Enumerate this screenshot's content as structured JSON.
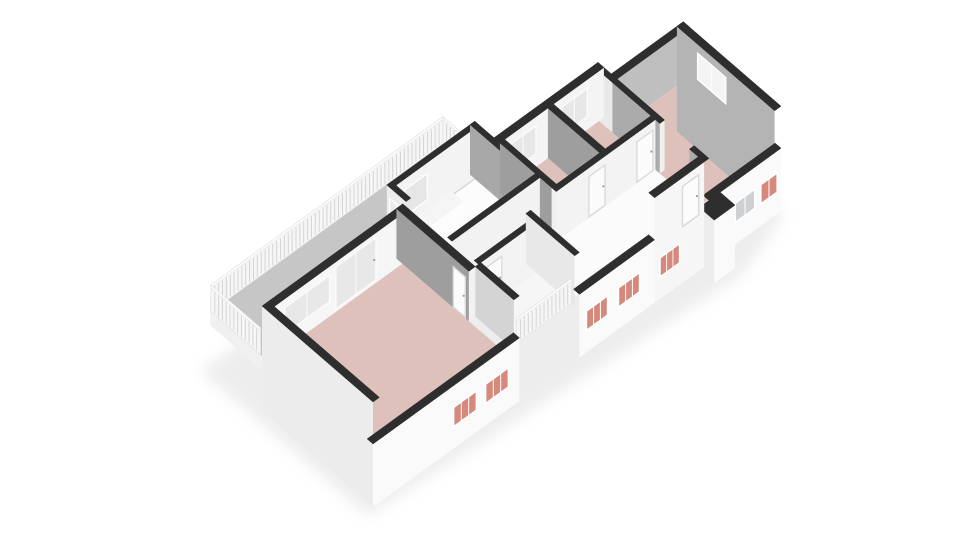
{
  "scene": {
    "origin": [
      262,
      356
    ],
    "u": [
      0.8,
      -0.58
    ],
    "v": [
      0.74,
      0.64
    ],
    "wall_height": 50,
    "slab_depth": -55,
    "palette": {
      "background": "#ffffff",
      "cap_dark": "#2e2e2e",
      "floor_pink": "#dfc1bc",
      "floor_white": "#fcfcfc",
      "floor_balcony": "#c6c6c7",
      "wall_gray": "#9e9e9e",
      "wall_white": "#f3f3f3",
      "exterior_white": "#fafafa",
      "exterior_gray": "#ececec",
      "glass": "#e8e8e9",
      "window_pink": "#d4897c",
      "railing_white": "#f6f6f6",
      "picket_gray": "#d4d4d6",
      "shadow": "#dcdcdc"
    },
    "shadow": {
      "points": [
        [
          -8,
          -74
        ],
        [
          292,
          -74
        ],
        [
          292,
          -2
        ],
        [
          410,
          -2
        ],
        [
          416,
          14
        ],
        [
          512,
          14
        ],
        [
          512,
          152
        ],
        [
          436,
          178
        ],
        [
          -8,
          152
        ]
      ],
      "z": -58,
      "fill": "#dcdcdc",
      "opacity": 0.5
    },
    "quads": [
      {
        "n": "balcony-fascia-left",
        "t": "qu",
        "x": 0,
        "y": [
          -70,
          0
        ],
        "z": [
          -14,
          0
        ],
        "fill": "#f0f0f0"
      },
      {
        "n": "balcony-fascia-front",
        "t": "qv",
        "y": -70,
        "x": [
          0,
          290
        ],
        "z": [
          -12,
          0
        ],
        "fill": "#f2f2f2"
      }
    ],
    "floors": [
      {
        "n": "balcony-floor",
        "r": [
          0,
          -70,
          290,
          0
        ],
        "fill": "#c6c6c7"
      },
      {
        "n": "living-room-floor",
        "r": [
          8,
          8,
          168,
          142
        ],
        "fill": "#dfc1bc"
      },
      {
        "n": "bathroom-floor",
        "r": [
          186,
          -19,
          284,
          56
        ],
        "fill": "#fcfcfc"
      },
      {
        "n": "hall-floor",
        "r": [
          180,
          62,
          290,
          92
        ],
        "fill": "#fcfcfc"
      },
      {
        "n": "loggia-floor",
        "r": [
          183,
          98,
          252,
          144
        ],
        "fill": "#f6f6f7"
      },
      {
        "n": "bedroom-a-floor",
        "r": [
          296,
          8,
          350,
          78
        ],
        "fill": "#dfc1bc"
      },
      {
        "n": "bedroom-b-floor",
        "r": [
          357,
          8,
          414,
          78
        ],
        "fill": "#dfc1bc"
      },
      {
        "n": "corridor-floor",
        "r": [
          258,
          84,
          414,
          142
        ],
        "fill": "#fbfbfb"
      },
      {
        "n": "passage-floor",
        "r": [
          414,
          90,
          420,
          130
        ],
        "fill": "#dfc1bc"
      },
      {
        "n": "right-bedroom-floor",
        "r": [
          420,
          26,
          502,
          142
        ],
        "fill": "#dfc1bc"
      }
    ],
    "rails": [
      {
        "n": "balcony-railing-front",
        "p1": [
          0,
          -69
        ],
        "p2": [
          290,
          -69
        ],
        "h": 27
      },
      {
        "n": "balcony-railing-left",
        "p1": [
          0,
          -69
        ],
        "p2": [
          0,
          -2
        ],
        "h": 27
      },
      {
        "n": "balcony-railing-return",
        "p1": [
          290,
          -69
        ],
        "p2": [
          290,
          -24
        ],
        "h": 27
      },
      {
        "n": "loggia-railing",
        "p1": [
          183,
          146
        ],
        "p2": [
          252,
          146
        ],
        "h": 25
      }
    ],
    "boxes": [
      {
        "n": "left-end-wall",
        "r": [
          0,
          0,
          8,
          150
        ],
        "z": [
          -55,
          50
        ],
        "u": "#ececec"
      },
      {
        "n": "living-glass-wall",
        "r": [
          8,
          0,
          176,
          8
        ],
        "z": [
          0,
          50
        ],
        "v": "#f6f6f6",
        "dec": [
          {
            "f": "v",
            "a": [
              20,
              78
            ],
            "z": [
              14,
              42
            ],
            "fr": "#fbfbfb",
            "gl": "#e8e8e9",
            "p": 2
          },
          {
            "f": "v",
            "a": [
              84,
              136
            ],
            "z": [
              2,
              46
            ],
            "fr": "#fbfbfb",
            "gl": "#e8e8e9",
            "p": 2,
            "door": true
          }
        ]
      },
      {
        "n": "bath-bump-left-wall",
        "r": [
          180,
          -26,
          186,
          0
        ],
        "z": [
          0,
          50
        ],
        "u": "#ececec",
        "dec": [
          {
            "f": "u",
            "a": [
              -23,
              -4
            ],
            "z": [
              10,
              40
            ],
            "fr": "#ffffff",
            "gl": "#eaeaea",
            "p": 2
          }
        ]
      },
      {
        "n": "bath-bump-top-wall",
        "r": [
          180,
          -26,
          290,
          -20
        ],
        "z": [
          0,
          50
        ],
        "v": "#f3f3f3",
        "dec": [
          {
            "f": "v",
            "a": [
              196,
              226
            ],
            "z": [
              12,
              40
            ],
            "fr": "#fdfdfd",
            "gl": "#e6e6e7",
            "p": 1
          }
        ]
      },
      {
        "n": "bath-right-wall",
        "r": [
          284,
          -26,
          290,
          62
        ],
        "z": [
          0,
          50
        ],
        "u": "#a8a8a8"
      },
      {
        "n": "bedroom-facade-wall",
        "r": [
          290,
          0,
          420,
          8
        ],
        "z": [
          0,
          50
        ],
        "v": "#f4f4f4",
        "dec": [
          {
            "f": "v",
            "a": [
              302,
              336
            ],
            "z": [
              12,
              42
            ],
            "fr": "#fcfcfc",
            "gl": "#e7e7e8",
            "p": 2
          },
          {
            "f": "v",
            "a": [
              366,
              400
            ],
            "z": [
              12,
              42
            ],
            "fr": "#fcfcfc",
            "gl": "#e7e7e8",
            "p": 2
          }
        ]
      },
      {
        "n": "facade-step-wall",
        "r": [
          414,
          0,
          420,
          26
        ],
        "z": [
          0,
          50
        ],
        "u": "#e9e9e9"
      },
      {
        "n": "right-facade-wall",
        "r": [
          420,
          18,
          510,
          26
        ],
        "z": [
          0,
          50
        ],
        "v": "#bfbfbf"
      },
      {
        "n": "right-end-wall",
        "r": [
          502,
          18,
          510,
          150
        ],
        "z": [
          -55,
          50
        ],
        "u": "#b4b4b4",
        "dec": [
          {
            "f": "u",
            "a": [
              45,
              85
            ],
            "z": [
              14,
              42
            ],
            "fr": "#ffffff",
            "gl": "#f4f4f4",
            "p": 2
          }
        ]
      },
      {
        "n": "living-right-wall",
        "r": [
          168,
          0,
          176,
          98
        ],
        "z": [
          0,
          50
        ],
        "u": "#9e9e9e",
        "v": "#f2f2f2",
        "dec": [
          {
            "f": "u",
            "a": [
              76,
              94
            ],
            "z": [
              0,
              42
            ],
            "fr": "#d9d9d9",
            "gl": "#fbfbfb",
            "p": 1,
            "door": true
          }
        ]
      },
      {
        "n": "loggia-left-wall",
        "r": [
          176,
          98,
          183,
          150
        ],
        "z": [
          0,
          50
        ],
        "u": "#d4d4d4"
      },
      {
        "n": "bath-bottom-wall",
        "r": [
          180,
          56,
          290,
          62
        ],
        "z": [
          0,
          50
        ],
        "v": "#f2f2f2"
      },
      {
        "n": "loggia-top-wall",
        "r": [
          180,
          92,
          252,
          98
        ],
        "z": [
          0,
          50
        ],
        "v": "#f3f3f3",
        "dec": [
          {
            "f": "v",
            "a": [
              188,
              210
            ],
            "z": [
              0,
              42
            ],
            "fr": "#dcdcdc",
            "gl": "#fbfbfb",
            "p": 1,
            "door": true
          }
        ]
      },
      {
        "n": "loggia-right-wall",
        "r": [
          252,
          84,
          258,
          150
        ],
        "z": [
          0,
          50
        ],
        "u": "#e8e8e8"
      },
      {
        "n": "corridor-top-wall",
        "r": [
          290,
          78,
          414,
          84
        ],
        "z": [
          0,
          50
        ],
        "v": "#f3f3f3",
        "dec": [
          {
            "f": "v",
            "a": [
              330,
              352
            ],
            "z": [
              0,
              42
            ],
            "fr": "#dcdcdc",
            "gl": "#fbfbfb",
            "p": 1,
            "door": true
          },
          {
            "f": "v",
            "a": [
              390,
              412
            ],
            "z": [
              0,
              42
            ],
            "fr": "#dcdcdc",
            "gl": "#fbfbfb",
            "p": 1,
            "door": true
          }
        ]
      },
      {
        "n": "bedroom-divider-wall",
        "r": [
          350,
          8,
          357,
          78
        ],
        "z": [
          0,
          50
        ],
        "u": "#9e9e9e",
        "v": "#f0f0f0"
      },
      {
        "n": "bedroom-a-left-wall",
        "r": [
          290,
          8,
          296,
          78
        ],
        "z": [
          0,
          50
        ],
        "u": "#9e9e9e",
        "v": "#f0f0f0"
      },
      {
        "n": "right-block-left-wall-upper",
        "r": [
          414,
          26,
          420,
          90
        ],
        "z": [
          0,
          50
        ],
        "u": "#ababab",
        "v": "#f0f0f0"
      },
      {
        "n": "right-block-left-wall-lower",
        "r": [
          414,
          130,
          420,
          150
        ],
        "z": [
          0,
          50
        ],
        "u": "#ababab"
      },
      {
        "n": "low-facade-living",
        "r": [
          0,
          142,
          183,
          150
        ],
        "z": [
          -55,
          8
        ],
        "v": "#fafafa",
        "dec": [
          {
            "f": "v",
            "a": [
              100,
              130
            ],
            "z": [
              -34,
              -13
            ],
            "fr": "#ffffff",
            "gl": "#d4897c",
            "p": 3
          },
          {
            "f": "v",
            "a": [
              140,
              170
            ],
            "z": [
              -34,
              -13
            ],
            "fr": "#ffffff",
            "gl": "#d4897c",
            "p": 3
          }
        ]
      },
      {
        "n": "low-facade-middle",
        "r": [
          258,
          142,
          352,
          150
        ],
        "z": [
          -55,
          8
        ],
        "v": "#fafafa",
        "dec": [
          {
            "f": "v",
            "a": [
              266,
              294
            ],
            "z": [
              -34,
              -13
            ],
            "fr": "#ffffff",
            "gl": "#d4897c",
            "p": 3
          },
          {
            "f": "v",
            "a": [
              306,
              334
            ],
            "z": [
              -34,
              -13
            ],
            "fr": "#ffffff",
            "gl": "#d4897c",
            "p": 3
          }
        ]
      },
      {
        "n": "entry-wall",
        "r": [
          352,
          142,
          414,
          150
        ],
        "z": [
          -55,
          50
        ],
        "v": "#f6f6f6",
        "dec": [
          {
            "f": "v",
            "a": [
              358,
              384
            ],
            "z": [
              -34,
              -13
            ],
            "fr": "#ffffff",
            "gl": "#d4897c",
            "p": 3
          },
          {
            "f": "v",
            "a": [
              386,
              408
            ],
            "z": [
              0,
              42
            ],
            "fr": "#d9d9d9",
            "gl": "#fcfcfc",
            "p": 1,
            "door": true
          }
        ]
      },
      {
        "n": "low-facade-right",
        "r": [
          420,
          142,
          510,
          150
        ],
        "z": [
          -55,
          8
        ],
        "v": "#fafafa",
        "dec": [
          {
            "f": "v",
            "a": [
              452,
              478
            ],
            "z": [
              -34,
              -13
            ],
            "fr": "#ffffff",
            "gl": "#cfd0d1",
            "p": 2
          },
          {
            "f": "v",
            "a": [
              484,
              506
            ],
            "z": [
              -34,
              -13
            ],
            "fr": "#ffffff",
            "gl": "#d4897c",
            "p": 2
          }
        ]
      },
      {
        "n": "facade-protrusion",
        "r": [
          408,
          150,
          434,
          170
        ],
        "z": [
          -55,
          8
        ],
        "u": "#ededed",
        "v": "#fafafa"
      },
      {
        "n": "bathtub",
        "r": [
          192,
          -12,
          248,
          4
        ],
        "z": [
          0,
          13
        ],
        "cap": "#f5f5f5",
        "u": "#fdfdfd",
        "v": "#fdfdfd"
      }
    ]
  }
}
